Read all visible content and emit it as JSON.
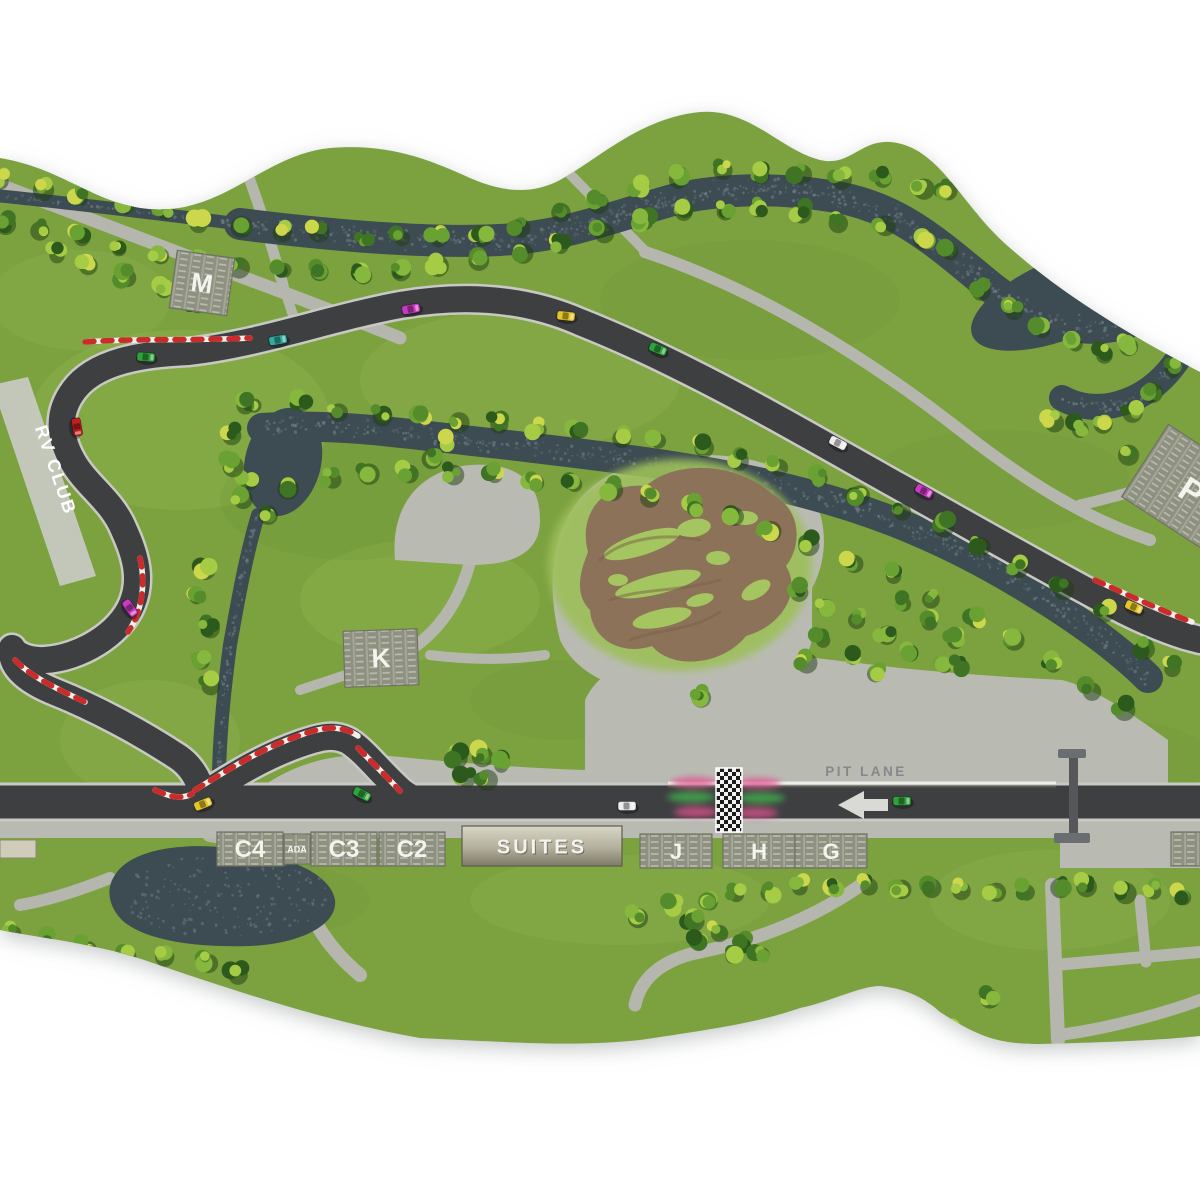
{
  "map": {
    "labels": {
      "rv_club": "RV CLUB",
      "pit_lane": "PIT LANE",
      "suites": "SUITES"
    },
    "parking_lots": [
      {
        "id": "m",
        "label": "M"
      },
      {
        "id": "k",
        "label": "K"
      },
      {
        "id": "p",
        "label": "P"
      },
      {
        "id": "c4",
        "label": "C4"
      },
      {
        "id": "ada",
        "label": "ADA"
      },
      {
        "id": "c3",
        "label": "C3"
      },
      {
        "id": "c2",
        "label": "C2"
      },
      {
        "id": "j",
        "label": "J"
      },
      {
        "id": "h",
        "label": "H"
      },
      {
        "id": "g",
        "label": "G"
      }
    ],
    "icons": {
      "pit_arrow": "arrow-left-icon",
      "start_finish": "start-finish-checkered-icon",
      "bridge": "pedestrian-bridge"
    },
    "colors": {
      "grass": "#7ca241",
      "water": "#3d4b52",
      "track": "#3e3f41",
      "track_edge": "#c8c9c3",
      "road": "#b5b7ae",
      "curb_red": "#cc2b2b",
      "dirt": "#8b7258",
      "lot": "#8e9181",
      "suites_light": "#d6d3c2",
      "suites_dark": "#7e7a68",
      "streak_pink": "#e0518e",
      "streak_green": "#3faf4c"
    },
    "cars": [
      {
        "x": 77,
        "y": 427,
        "rot": 80,
        "color": "#c0201f"
      },
      {
        "x": 130,
        "y": 608,
        "rot": 55,
        "color": "#c73bbf"
      },
      {
        "x": 146,
        "y": 357,
        "rot": 4,
        "color": "#2fa23d"
      },
      {
        "x": 278,
        "y": 340,
        "rot": -10,
        "color": "#35a8a0"
      },
      {
        "x": 411,
        "y": 309,
        "rot": -10,
        "color": "#c73bbf"
      },
      {
        "x": 566,
        "y": 316,
        "rot": 6,
        "color": "#e3c52b"
      },
      {
        "x": 658,
        "y": 349,
        "rot": 22,
        "color": "#2fa23d"
      },
      {
        "x": 838,
        "y": 443,
        "rot": 27,
        "color": "#ececec"
      },
      {
        "x": 924,
        "y": 491,
        "rot": 28,
        "color": "#c73bbf"
      },
      {
        "x": 1134,
        "y": 607,
        "rot": 24,
        "color": "#e3c52b"
      },
      {
        "x": 203,
        "y": 804,
        "rot": -22,
        "color": "#e3c52b"
      },
      {
        "x": 362,
        "y": 794,
        "rot": 28,
        "color": "#2fa23d"
      },
      {
        "x": 627,
        "y": 806,
        "rot": 0,
        "color": "#ececec"
      },
      {
        "x": 902,
        "y": 801,
        "rot": 0,
        "color": "#2fa23d"
      }
    ]
  }
}
